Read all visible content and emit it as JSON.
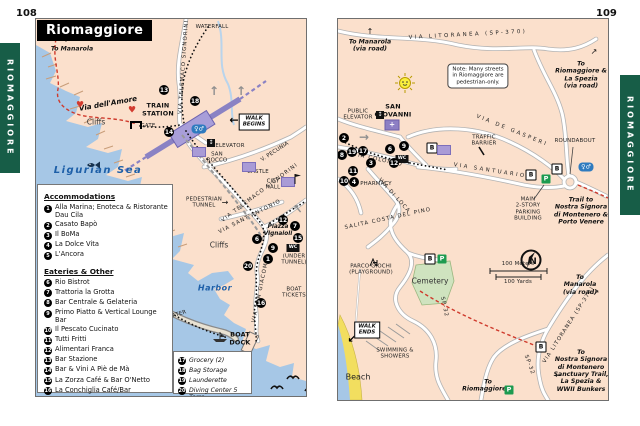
{
  "doc": {
    "left_page_number": "108",
    "right_page_number": "109",
    "tab_label": "RIOMAGGIORE",
    "title": "Riomaggiore"
  },
  "colors": {
    "tab_green": "#175d47",
    "land": "#fbe0cc",
    "sea": "#a6c7e6",
    "trail_red": "#cf3a2c",
    "building_purple": "#a99bd6",
    "parking_green": "#1d9b50",
    "wc_blue": "#2f7bbf"
  },
  "legend": {
    "heading_accommodations": "Accommodations",
    "accommodations": [
      {
        "n": "1",
        "label": "Alla Marina; Enoteca & Ristorante Dau Cila"
      },
      {
        "n": "2",
        "label": "Casato Bapò"
      },
      {
        "n": "3",
        "label": "Il BoMa"
      },
      {
        "n": "4",
        "label": "La Dolce Vita"
      },
      {
        "n": "5",
        "label": "L'Ancora"
      }
    ],
    "heading_eateries": "Eateries & Other",
    "eateries": [
      {
        "n": "6",
        "label": "Rio Bistrot"
      },
      {
        "n": "7",
        "label": "Trattoria la Grotta"
      },
      {
        "n": "8",
        "label": "Bar Centrale & Gelateria"
      },
      {
        "n": "9",
        "label": "Primo Piatto & Vertical Lounge Bar"
      },
      {
        "n": "10",
        "label": "Il Pescato Cucinato"
      },
      {
        "n": "11",
        "label": "Tutti Fritti"
      },
      {
        "n": "12",
        "label": "Alimentari Franca"
      },
      {
        "n": "13",
        "label": "Bar Stazione"
      },
      {
        "n": "14",
        "label": "Bar & Vini A Piè de Mà"
      },
      {
        "n": "15",
        "label": "La Zorza Café & Bar O'Netto"
      },
      {
        "n": "16",
        "label": "La Conchiglia Café/Bar"
      }
    ],
    "services": [
      {
        "n": "17",
        "label": "Grocery (2)"
      },
      {
        "n": "18",
        "label": "Bag Storage"
      },
      {
        "n": "19",
        "label": "Launderette"
      },
      {
        "n": "20",
        "label": "Diving Center 5 Terre"
      }
    ]
  },
  "left_map": {
    "labels": [
      {
        "t": "To Manarola",
        "x": 36,
        "y": 30,
        "c": "dir",
        "n": "to-manarola-label"
      },
      {
        "t": "Via dell'Amore",
        "x": 72,
        "y": 85,
        "c": "street-it",
        "r": -10,
        "n": "via-dellamore-label"
      },
      {
        "t": "Cliffs",
        "x": 60,
        "y": 104,
        "c": "plain",
        "n": "cliffs-label"
      },
      {
        "t": "Cliffs",
        "x": 183,
        "y": 227,
        "c": "plain",
        "n": "cliffs-label"
      },
      {
        "t": "WATERFALL",
        "x": 176,
        "y": 8,
        "c": "tiny",
        "n": "waterfall-label"
      },
      {
        "t": "TRAIN\nSTATION",
        "x": 122,
        "y": 91,
        "c": "b",
        "n": "train-station-label"
      },
      {
        "t": "GATE",
        "x": 112,
        "y": 107,
        "c": "tiny",
        "n": "gate-label"
      },
      {
        "t": "WALK\nBEGINS",
        "x": 218,
        "y": 103,
        "c": "sign",
        "n": "walk-begins-sign"
      },
      {
        "t": "ELEVATOR",
        "x": 194,
        "y": 127,
        "c": "tiny",
        "n": "elevator-label"
      },
      {
        "t": "SAN\nROCCO",
        "x": 181,
        "y": 139,
        "c": "tiny",
        "n": "san-rocco-label"
      },
      {
        "t": "V. PECUNIA",
        "x": 239,
        "y": 133,
        "c": "tiny",
        "r": -33,
        "n": "via-pecunia-label"
      },
      {
        "t": "CASTLE",
        "x": 222,
        "y": 153,
        "c": "tiny",
        "n": "castle-label"
      },
      {
        "t": "CITY\nHALL",
        "x": 237,
        "y": 166,
        "c": "tiny",
        "n": "city-hall-label"
      },
      {
        "t": "PEDESTRIAN\nTUNNEL",
        "x": 168,
        "y": 184,
        "c": "tiny",
        "n": "pedestrian-tunnel-label"
      },
      {
        "t": "VIA TELEMACO SIGNORINI",
        "x": 148,
        "y": 48,
        "c": "st",
        "r": -86,
        "n": "via-telemaco-signorini-label"
      },
      {
        "t": "VIA TELEMACO SIGNORINI",
        "x": 224,
        "y": 174,
        "c": "st",
        "r": -37,
        "n": "via-telemaco-signorini-label"
      },
      {
        "t": "VIA SANT'ANTONIO",
        "x": 214,
        "y": 198,
        "c": "st",
        "r": -27,
        "n": "via-santantonio-label"
      },
      {
        "t": "Piazza\nVignaioli",
        "x": 242,
        "y": 212,
        "c": "it-sm",
        "n": "piazza-vignaioli-label"
      },
      {
        "t": "(UNDER\nTUNNEL)",
        "x": 258,
        "y": 241,
        "c": "tiny",
        "n": "under-tunnel-label"
      },
      {
        "t": "Harbor",
        "x": 179,
        "y": 269,
        "c": "sea sea-sm",
        "n": "harbor-label"
      },
      {
        "t": "BREAKWATER",
        "x": 132,
        "y": 299,
        "c": "tiny",
        "r": -17,
        "n": "breakwater-label"
      },
      {
        "t": "BOAT\nTICKETS",
        "x": 258,
        "y": 274,
        "c": "tiny",
        "n": "boat-tickets-label"
      },
      {
        "t": "BOAT\nDOCK",
        "x": 204,
        "y": 320,
        "c": "b",
        "n": "boat-dock-label"
      },
      {
        "t": "VIA SAN GIACOMO",
        "x": 225,
        "y": 271,
        "c": "st",
        "r": -78,
        "n": "via-san-giacomo-label"
      },
      {
        "t": "Ligurian Sea",
        "x": 62,
        "y": 152,
        "c": "sea",
        "n": "ligurian-sea-label"
      }
    ],
    "markers": [
      {
        "n": "13",
        "x": 128,
        "y": 71
      },
      {
        "n": "18",
        "x": 159,
        "y": 82
      },
      {
        "n": "14",
        "x": 133,
        "y": 113
      },
      {
        "n": "12",
        "x": 247,
        "y": 201
      },
      {
        "n": "7",
        "x": 259,
        "y": 207
      },
      {
        "n": "15",
        "x": 262,
        "y": 219
      },
      {
        "n": "6",
        "x": 221,
        "y": 220
      },
      {
        "n": "9",
        "x": 237,
        "y": 229
      },
      {
        "n": "1",
        "x": 232,
        "y": 240
      },
      {
        "n": "20",
        "x": 212,
        "y": 247
      },
      {
        "n": "16",
        "x": 225,
        "y": 284
      }
    ],
    "icons": [
      {
        "k": "dir-up",
        "x": 30,
        "y": 21
      },
      {
        "k": "heart",
        "x": 44,
        "y": 87
      },
      {
        "k": "heart",
        "x": 96,
        "y": 92
      },
      {
        "k": "gate",
        "x": 100,
        "y": 106
      },
      {
        "k": "walk-arrow-left",
        "x": 198,
        "y": 101
      },
      {
        "k": "wc-blue",
        "x": 163,
        "y": 110
      },
      {
        "k": "elev",
        "x": 175,
        "y": 124
      },
      {
        "k": "bldg",
        "x": 163,
        "y": 133
      },
      {
        "k": "bldg",
        "x": 213,
        "y": 148
      },
      {
        "k": "bldg",
        "x": 252,
        "y": 163
      },
      {
        "k": "flag",
        "x": 258,
        "y": 155
      },
      {
        "k": "dir-right",
        "x": 189,
        "y": 184
      },
      {
        "k": "wc-black",
        "x": 257,
        "y": 229
      },
      {
        "k": "gray-up",
        "x": 178,
        "y": 72
      },
      {
        "k": "gray-up",
        "x": 205,
        "y": 72
      },
      {
        "k": "gray-up",
        "x": 262,
        "y": 190,
        "r": -40
      },
      {
        "k": "fish",
        "x": 50,
        "y": 141
      },
      {
        "k": "boat",
        "x": 176,
        "y": 313
      },
      {
        "k": "bird",
        "x": 250,
        "y": 354
      },
      {
        "k": "bird",
        "x": 268,
        "y": 366
      },
      {
        "k": "bird",
        "x": 234,
        "y": 364
      }
    ]
  },
  "right_map": {
    "labels": [
      {
        "t": "To Manarola\n(via road)",
        "x": 32,
        "y": 27,
        "c": "dir",
        "n": "to-manarola-label"
      },
      {
        "t": "VIA LITORANEA (SP-370)",
        "x": 130,
        "y": 16,
        "c": "st sp",
        "r": -3,
        "n": "via-litoranea-label"
      },
      {
        "t": "Note: Many streets\nin Riomaggiore are\npedestrian-only.",
        "x": 140,
        "y": 57,
        "c": "note",
        "n": "note-box"
      },
      {
        "t": "To\nRiomaggiore &\nLa Spezia\n(via road)",
        "x": 243,
        "y": 56,
        "c": "dir",
        "n": "to-riomaggiore-la-spezia-label"
      },
      {
        "t": "PUBLIC\nELEVATOR",
        "x": 20,
        "y": 96,
        "c": "tiny",
        "n": "public-elevator-label"
      },
      {
        "t": "SAN\nGIOVANNI",
        "x": 55,
        "y": 92,
        "c": "b",
        "n": "san-giovanni-label"
      },
      {
        "t": "TRAFFIC\nBARRIER",
        "x": 146,
        "y": 122,
        "c": "tiny",
        "n": "traffic-barrier-label"
      },
      {
        "t": "VIA DE GASPERI",
        "x": 174,
        "y": 112,
        "c": "st sp",
        "r": 22,
        "n": "via-de-gasperi-label"
      },
      {
        "t": "VIA SANTUARIO",
        "x": 152,
        "y": 152,
        "c": "st sp",
        "r": 9,
        "n": "via-santuario-label"
      },
      {
        "t": "ROUNDABOUT",
        "x": 237,
        "y": 122,
        "c": "tiny",
        "n": "roundabout-label"
      },
      {
        "t": "MAIN\n2-STORY\nPARKING\nBUILDING",
        "x": 190,
        "y": 190,
        "c": "tiny",
        "n": "parking-building-label"
      },
      {
        "t": "Trail to\nNostra Signora\ndi Montenero &\nPorto Venere",
        "x": 243,
        "y": 192,
        "c": "dir",
        "n": "trail-nostra-signora-label"
      },
      {
        "t": "VIA COLOMBO",
        "x": 40,
        "y": 141,
        "c": "st",
        "r": 12,
        "n": "via-colombo-label"
      },
      {
        "t": "PHARMACY",
        "x": 38,
        "y": 165,
        "c": "tiny",
        "n": "pharmacy-label"
      },
      {
        "t": "VIA DI LOCA",
        "x": 56,
        "y": 177,
        "c": "st",
        "r": 48,
        "n": "via-di-loca-label"
      },
      {
        "t": "SALITA COSTA DEL PINO",
        "x": 50,
        "y": 200,
        "c": "st",
        "r": -12,
        "n": "salita-costa-del-pino-label"
      },
      {
        "t": "SP-32",
        "x": 106,
        "y": 288,
        "c": "st",
        "r": 78,
        "n": "sp32-label"
      },
      {
        "t": "SP-32",
        "x": 191,
        "y": 346,
        "c": "st",
        "r": 70,
        "n": "sp32-label"
      },
      {
        "t": "VIA LITORANEA (SP-370)",
        "x": 231,
        "y": 306,
        "c": "st",
        "r": -57,
        "n": "via-litoranea-label"
      },
      {
        "t": "To\nManarola\n(via road)",
        "x": 242,
        "y": 266,
        "c": "dir",
        "n": "to-manarola-label"
      },
      {
        "t": "To\nNostra Signora\ndi Montenero\nSanctuary Trail,\nLa Spezia &\nWWII Bunkers",
        "x": 243,
        "y": 352,
        "c": "dir",
        "n": "to-nostra-signora-label"
      },
      {
        "t": "To\nRiomaggiore &",
        "x": 150,
        "y": 367,
        "c": "dir",
        "n": "to-riomaggiore-label"
      },
      {
        "t": "PARCO GIOCHI\n(PLAYGROUND)",
        "x": 33,
        "y": 251,
        "c": "tiny",
        "n": "parco-giochi-label"
      },
      {
        "t": "Cemetery",
        "x": 92,
        "y": 263,
        "c": "plain",
        "n": "cemetery-label"
      },
      {
        "t": "WALK\nENDS",
        "x": 29,
        "y": 311,
        "c": "sign",
        "n": "walk-ends-sign"
      },
      {
        "t": "SWIMMING &\nSHOWERS",
        "x": 57,
        "y": 335,
        "c": "tiny",
        "n": "swimming-showers-label"
      },
      {
        "t": "Beach",
        "x": 20,
        "y": 358,
        "c": "beach",
        "n": "beach-label"
      },
      {
        "t": "100 Meters",
        "x": 180,
        "y": 245,
        "c": "tiny",
        "n": "scale-meters-label"
      },
      {
        "t": "100 Yards",
        "x": 180,
        "y": 263,
        "c": "tiny",
        "n": "scale-yards-label"
      }
    ],
    "markers": [
      {
        "n": "2",
        "x": 6,
        "y": 119
      },
      {
        "n": "8",
        "x": 4,
        "y": 136
      },
      {
        "n": "19",
        "x": 14,
        "y": 133
      },
      {
        "n": "17",
        "x": 25,
        "y": 132
      },
      {
        "n": "6",
        "x": 52,
        "y": 130
      },
      {
        "n": "9",
        "x": 66,
        "y": 127
      },
      {
        "n": "3",
        "x": 33,
        "y": 144
      },
      {
        "n": "12",
        "x": 56,
        "y": 144
      },
      {
        "n": "11",
        "x": 15,
        "y": 152
      },
      {
        "n": "10",
        "x": 6,
        "y": 162
      },
      {
        "n": "4",
        "x": 16,
        "y": 163
      }
    ],
    "icons": [
      {
        "k": "dir-up",
        "x": 32,
        "y": 13
      },
      {
        "k": "dir-ur",
        "x": 256,
        "y": 33
      },
      {
        "k": "sun",
        "x": 57,
        "y": 54
      },
      {
        "k": "elev",
        "x": 42,
        "y": 96
      },
      {
        "k": "church",
        "x": 54,
        "y": 106
      },
      {
        "k": "gray-right",
        "x": 26,
        "y": 118
      },
      {
        "k": "wc-black",
        "x": 64,
        "y": 140
      },
      {
        "k": "bus",
        "x": 94,
        "y": 129
      },
      {
        "k": "bldg",
        "x": 106,
        "y": 131
      },
      {
        "k": "bus",
        "x": 193,
        "y": 156
      },
      {
        "k": "bus",
        "x": 219,
        "y": 150
      },
      {
        "k": "parking",
        "x": 208,
        "y": 160
      },
      {
        "k": "wc-blue",
        "x": 248,
        "y": 148
      },
      {
        "k": "play",
        "x": 31,
        "y": 239
      },
      {
        "k": "bus",
        "x": 92,
        "y": 240
      },
      {
        "k": "parking",
        "x": 104,
        "y": 240
      },
      {
        "k": "compass",
        "x": 180,
        "y": 228
      },
      {
        "k": "dir-ur",
        "x": 258,
        "y": 274
      },
      {
        "k": "bus",
        "x": 203,
        "y": 328
      },
      {
        "k": "walk-arrow-dl",
        "x": 14,
        "y": 320
      },
      {
        "k": "dir-left",
        "x": 220,
        "y": 357
      },
      {
        "k": "parking",
        "x": 171,
        "y": 371
      }
    ]
  }
}
